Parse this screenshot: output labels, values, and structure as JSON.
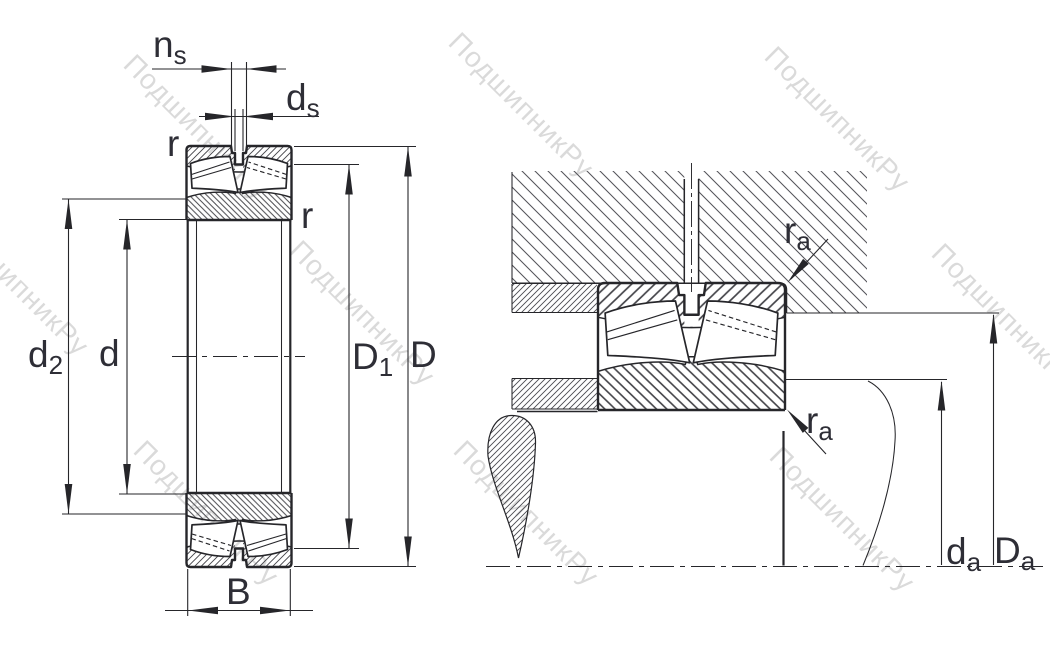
{
  "drawing_type": "bearing engineering drawing (spherical roller bearing: cross-section and mounting abutment dimensions)",
  "watermark": {
    "text": "ПодшипникРу"
  },
  "left_view": {
    "name": "bearing cross-section with boundary dimensions",
    "labels": {
      "ns": {
        "main": "n",
        "sub": "s"
      },
      "ds": {
        "main": "d",
        "sub": "s"
      },
      "r_outer": "r",
      "r_inner": "r",
      "d2": {
        "main": "d",
        "sub": "2"
      },
      "d": "d",
      "D1": {
        "main": "D",
        "sub": "1"
      },
      "D": "D",
      "B": "B"
    }
  },
  "right_view": {
    "name": "mounted bearing with shaft and housing abutment dimensions",
    "labels": {
      "ra_top": {
        "main": "r",
        "sub": "a"
      },
      "ra_bottom": {
        "main": "r",
        "sub": "a"
      },
      "da": {
        "main": "d",
        "sub": "a"
      },
      "Da": {
        "main": "D",
        "sub": "a"
      }
    }
  },
  "colors": {
    "line": "#26262a",
    "label": "#2e2e36",
    "watermark": "#bcbcbc",
    "background": "#ffffff"
  }
}
